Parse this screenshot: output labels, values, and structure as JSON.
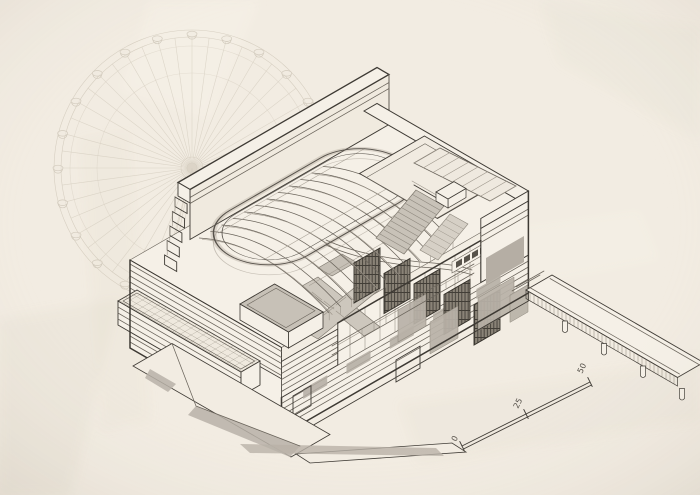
{
  "drawing": {
    "scale_bar": {
      "labels": [
        "0",
        "25",
        "50"
      ]
    },
    "palette": {
      "paper": "#f2ece2",
      "paper_light": "#f5f0e7",
      "ink": "#3e3a34",
      "ink_medium": "#6b655c",
      "ink_light": "#9c958a",
      "sketch_faint": "#cdc5b6",
      "fill_gray": "#b9b2a8",
      "fill_gray_light": "#cdc7bd",
      "hatch_dark": "#3b3731",
      "stair_gray": "#c8c2b8"
    }
  }
}
